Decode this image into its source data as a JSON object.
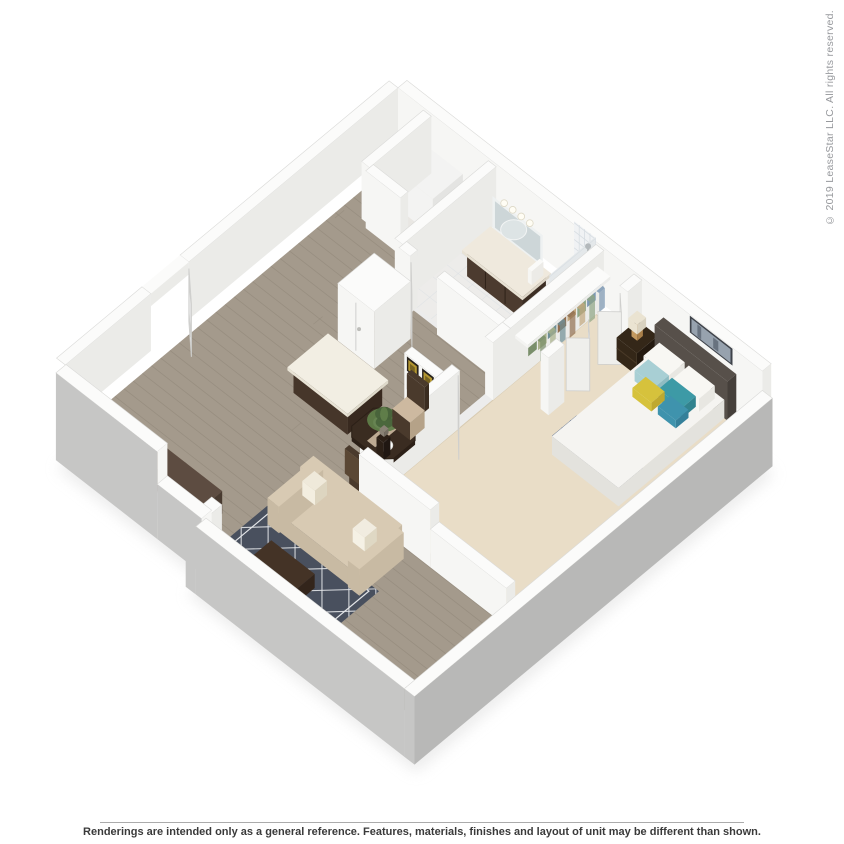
{
  "copyright": {
    "text": "© 2019 LeaseStar LLC. All rights reserved.",
    "color": "#97999d"
  },
  "footer": {
    "disclaimer": "Renderings are intended only as a general reference. Features, materials, finishes and layout of unit may be different than shown.",
    "text_color": "#3a3a3a",
    "divider_color": "#ababab"
  },
  "floorplan": {
    "type": "3d-isometric-floor-plan",
    "unit_type": "one-bedroom apartment",
    "rooms": [
      "entry",
      "hallway",
      "kitchen",
      "dining-area",
      "living-room",
      "bedroom",
      "bathroom",
      "walk-in-closet",
      "laundry-utility"
    ],
    "furniture": [
      "front-door",
      "washer-unit",
      "vanity",
      "mirror",
      "shower",
      "closet-clothes",
      "bifold-doors",
      "nightstand",
      "lamp",
      "bed",
      "headboard",
      "wall-art-bedroom",
      "wall-art-dining",
      "kitchen-island",
      "bar-counter",
      "dining-table",
      "dining-chairs",
      "plant-centerpiece",
      "sofa",
      "throw-pillows",
      "coffee-table",
      "area-rug",
      "windows",
      "pantry"
    ],
    "palette": {
      "wall_top": "#fbfbfa",
      "wall_edge": "#dadad8",
      "wall_int_sw": "#f6f6f4",
      "wall_int_se": "#ebebe8",
      "wall_ext_sw": "#c6c6c5",
      "wall_ext_se": "#b8b8b7",
      "floor_wood": "#a49a8c",
      "floor_wood_line": "#8a8173",
      "floor_bath": "#edecea",
      "floor_util": "#e9e7e3",
      "floor_carpet": "#e9ddc7",
      "carpet_edge": "#d8cbb2",
      "counter_dark_top": "#5d4c41",
      "counter_dark_front": "#483a30",
      "island_base": "#46362a",
      "island_base_dk": "#38291f",
      "island_top": "#f2eee3",
      "vanity_base": "#4c3b2f",
      "vanity_base_dk": "#3c2e24",
      "vanity_top": "#efe9dd",
      "mirror": "#cdd6d8",
      "tile": "#f0f2f4",
      "tile2": "#e4e8ea",
      "tile_line": "#d7dde2",
      "chrome": "#b4b9bc",
      "bed_white": "#f5f4f1",
      "bed_side": "#e3e2dd",
      "bed_band": "#dbdbd6",
      "bed_runner": "#54688a",
      "bed_runner_dk": "#42557a",
      "headboard": "#57504a",
      "headboard_dk": "#453f3a",
      "pillow_white": "#f8f7f3",
      "pillow_teal": "#3d9aa6",
      "pillow_teal_lt": "#a8cfd4",
      "pillow_yellow": "#d6c23c",
      "pillow_steel": "#3f93ad",
      "nightstand": "#342718",
      "nightstand_dk": "#241a10",
      "lamp_shade": "#eae3d1",
      "lamp_body": "#c3995f",
      "art_frame": "#3f434a",
      "art_blue": "#97a2ae",
      "art_streak": "#68727f",
      "art_frame2": "#26211c",
      "art_gold": "#b2952f",
      "sofa": "#d8cab3",
      "sofa_shade": "#c8baa3",
      "sofa_dk": "#b7a992",
      "pillow_stripe": "#cfc089",
      "rug": "#49505e",
      "rug_line": "#e3e5e8",
      "coffee_table": "#33251b",
      "coffee_table_top": "#443326",
      "paper": "#fbfaf6",
      "paper2": "#e6b77d",
      "dining_table": "#3a2c21",
      "dining_table_dk": "#2c2017",
      "chair_frame": "#4a3a2c",
      "chair_cushion": "#cdb9a0",
      "plant": "#5f7d49",
      "plant_dark": "#47623a",
      "pot": "#8a8276",
      "door": "#fcfcfc",
      "door_edge": "#cfcfcd",
      "washer": "#f3f3f2",
      "washer_dk": "#e4e4e2",
      "window_frame": "#fdfdfd",
      "window_pane": "#eef1f2",
      "shadow": "#dedede",
      "clothes": [
        "#7d98b3",
        "#8ea584",
        "#c2a77e",
        "#916f50",
        "#6e8e96",
        "#a8b18a",
        "#7a8f6b"
      ]
    }
  }
}
